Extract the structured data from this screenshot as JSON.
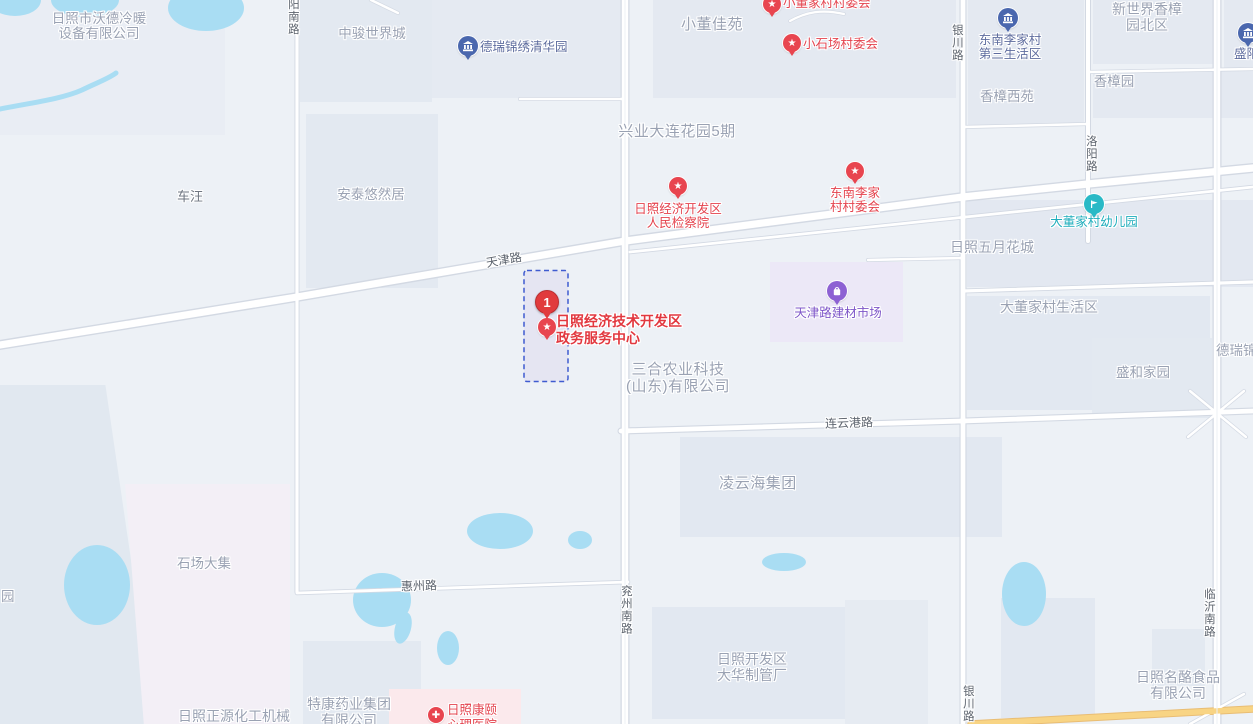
{
  "map": {
    "selected": {
      "marker_number": "1",
      "lines": [
        "日照经济技术开发区",
        "政务服务中心"
      ]
    },
    "roads": {
      "yangnanlu": "阳南路",
      "tianjinlu": "天津路",
      "yinchuanlu": "银川路",
      "luoyanglu": "洛阳路",
      "lianyungang": "连云港路",
      "huizhoulu": "惠州路",
      "yanzhounanlu": "兖州南路",
      "linyinanlu": "临沂南路"
    },
    "labels": {
      "wode": {
        "lines": [
          "日照市沃德冷暖",
          "设备有限公司"
        ]
      },
      "zhongjun": {
        "text": "中骏世界城"
      },
      "chewang": {
        "text": "车汪"
      },
      "antai": {
        "text": "安泰悠然居"
      },
      "derui_qinghua": {
        "text": "德瑞锦绣清华园"
      },
      "xiaodong_jiayuan": {
        "text": "小董佳苑"
      },
      "xingye": {
        "text": "兴业大连花园5期"
      },
      "xiaodong_cmte": {
        "text": "小董家村村委会"
      },
      "xiaoshichang_cmte": {
        "text": "小石场村委会"
      },
      "dongnan_shenghuoqu": {
        "lines": [
          "东南李家村",
          "第三生活区"
        ]
      },
      "xinshijie": {
        "lines": [
          "新世界香樟",
          "园北区"
        ]
      },
      "xiangzhang_yuan": {
        "text": "香樟园"
      },
      "xiangzhang_xiyuan": {
        "text": "香樟西苑"
      },
      "sheng_partial": {
        "text": "盛阳"
      },
      "jianchayuan": {
        "lines": [
          "日照经济开发区",
          "人民检察院"
        ]
      },
      "dongnan_cmte": {
        "lines": [
          "东南李家",
          "村村委会"
        ]
      },
      "wuyue": {
        "text": "日照五月花城"
      },
      "youeryuan": {
        "text": "大董家村幼儿园"
      },
      "jiancai": {
        "text": "天津路建材市场"
      },
      "dadongjia_shenghuoqu": {
        "text": "大董家村生活区"
      },
      "shenghe": {
        "text": "盛和家园"
      },
      "derui_partial": {
        "text": "德瑞锦"
      },
      "sanhe": {
        "lines": [
          "三合农业科技",
          "(山东)有限公司"
        ]
      },
      "lingyunhai": {
        "text": "凌云海集团"
      },
      "shichang_daji": {
        "text": "石场大集"
      },
      "yuan_partial": {
        "text": "园"
      },
      "dahua": {
        "lines": [
          "日照开发区",
          "大华制管厂"
        ]
      },
      "tekang": {
        "lines": [
          "特康药业集团",
          "有限公司"
        ]
      },
      "zhengyuan": {
        "text": "日照正源化工机械"
      },
      "kangyi": {
        "lines": [
          "日照康颐",
          "心理医院"
        ]
      },
      "minglao": {
        "lines": [
          "日照名酪食品",
          "有限公司"
        ]
      }
    },
    "colors": {
      "background": "#edf1f6",
      "block": "#e3e9f1",
      "water": "#a9ddf3",
      "road_fill": "#ffffff",
      "road_casing": "#d3d9e3",
      "arterial_orange": "#f8d484",
      "poi_red": "#e8454f",
      "marker_red": "#e13b3d",
      "poi_blue_icon": "#4a67ae",
      "poi_blue_text": "#5e6c9e",
      "poi_purple": "#8d61d3",
      "poi_teal": "#29b9c6",
      "area_text": "#9aa2b3",
      "road_text": "#5d646e",
      "selection_border": "#3f5bd0"
    }
  }
}
